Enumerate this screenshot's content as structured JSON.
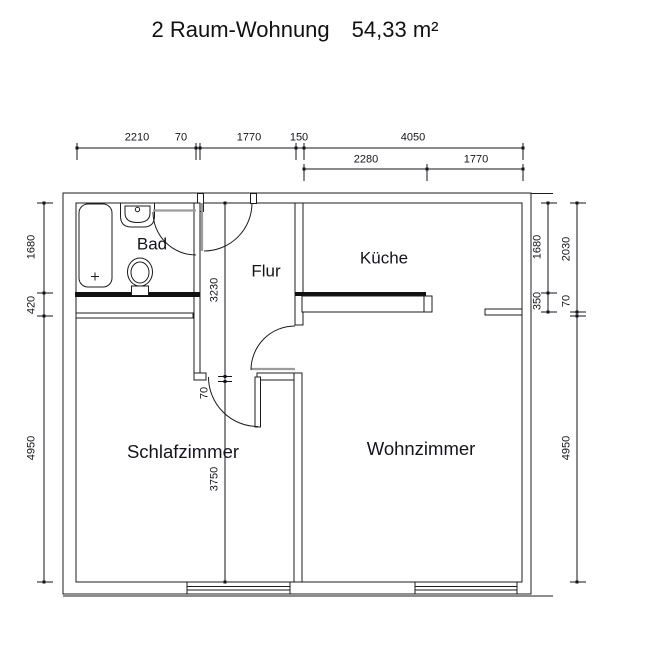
{
  "apartment": {
    "name": "2 Raum-Wohnung",
    "area": "54,33 m²"
  },
  "rooms": {
    "bad": "Bad",
    "flur": "Flur",
    "kueche": "Küche",
    "schlafzimmer": "Schlafzimmer",
    "wohnzimmer": "Wohnzimmer"
  },
  "dims": {
    "top1": [
      "2210",
      "70",
      "1770",
      "150",
      "4050"
    ],
    "top2": [
      "2280",
      "1770"
    ],
    "left": [
      "1680",
      "420",
      "4950"
    ],
    "right_inner": [
      "1680",
      "350"
    ],
    "right_outer": [
      "2030",
      "70",
      "4950"
    ],
    "flur_col": [
      "3230",
      "70",
      "3750"
    ]
  },
  "colors": {
    "line": "#1c1c1c",
    "door_leaf": "#9c9c9c",
    "text": "#14141e"
  }
}
